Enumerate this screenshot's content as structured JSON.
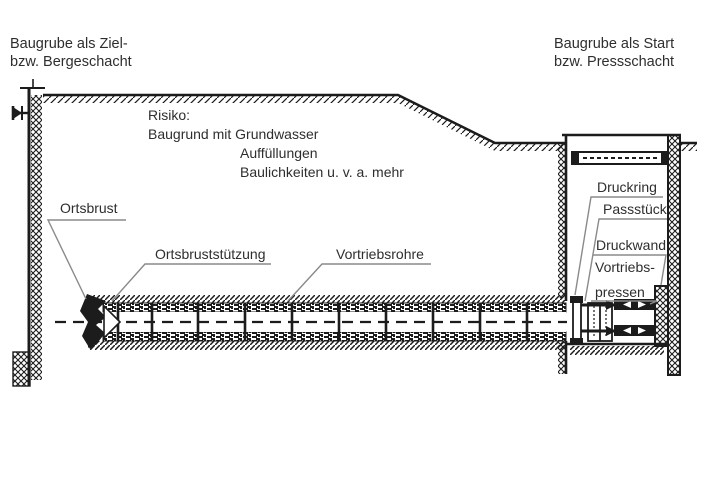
{
  "diagram": {
    "type": "technical-drawing",
    "subject": "Rohrvortrieb / pipe jacking scheme between two excavation shafts",
    "labels": {
      "target_shaft_line1": "Baugrube als Ziel-",
      "target_shaft_line2": "bzw. Bergeschacht",
      "start_shaft_line1": "Baugrube als Start",
      "start_shaft_line2": "bzw. Pressschacht",
      "risk_heading": "Risiko:",
      "risk_item1": "Baugrund mit Grundwasser",
      "risk_item2": "Auffüllungen",
      "risk_item3": "Baulichkeiten u. v. a. mehr",
      "tunnel_face": "Ortsbrust",
      "face_support": "Ortsbruststützung",
      "jacking_pipes": "Vortriebsrohre",
      "pressure_ring": "Druckring",
      "adapter_piece": "Passstück",
      "pressure_wall": "Druckwand",
      "jacking_presses_line1": "Vortriebs-",
      "jacking_presses_line2": "pressen"
    },
    "colors": {
      "ink": "#1c1c1c",
      "text": "#2e2e2e",
      "leader": "#8a8a8a",
      "background": "#ffffff"
    }
  }
}
